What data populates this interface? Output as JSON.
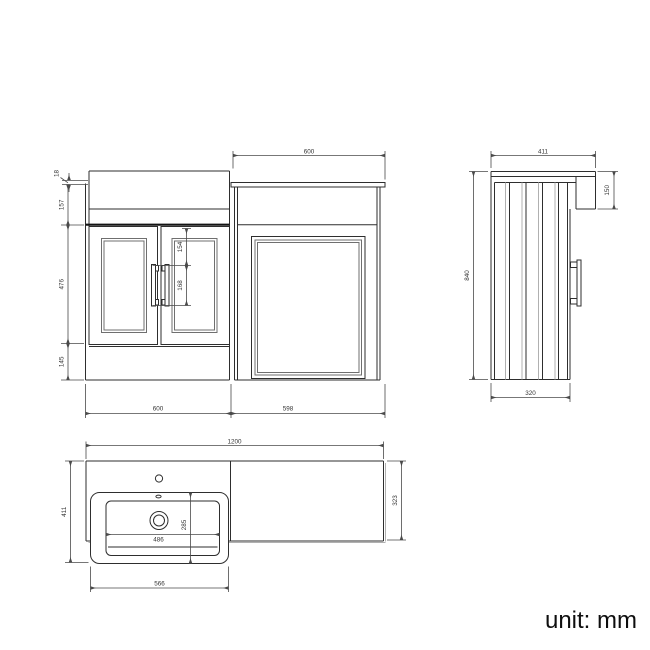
{
  "front": {
    "top_width": "600",
    "worktop_thickness": "18",
    "upper_height": "157",
    "door_height": "476",
    "plinth_height": "145",
    "handle_offset": "154",
    "handle_span": "168",
    "bottom_left_width": "600",
    "bottom_right_width": "598"
  },
  "side": {
    "depth": "411",
    "overhang_height": "150",
    "total_height": "840",
    "base_depth": "320"
  },
  "plan": {
    "total_width": "1200",
    "left_depth": "411",
    "right_depth": "323",
    "basin_outer_width": "566",
    "basin_inner_width": "486",
    "basin_depth": "285"
  },
  "footer": {
    "unit_label": "unit: mm"
  },
  "colors": {
    "line": "#2e2e2e",
    "heavy_line": "#141414",
    "light_line": "#b0b0b0",
    "dimension": "#4a4a4a",
    "text": "#333333",
    "background": "#ffffff"
  }
}
